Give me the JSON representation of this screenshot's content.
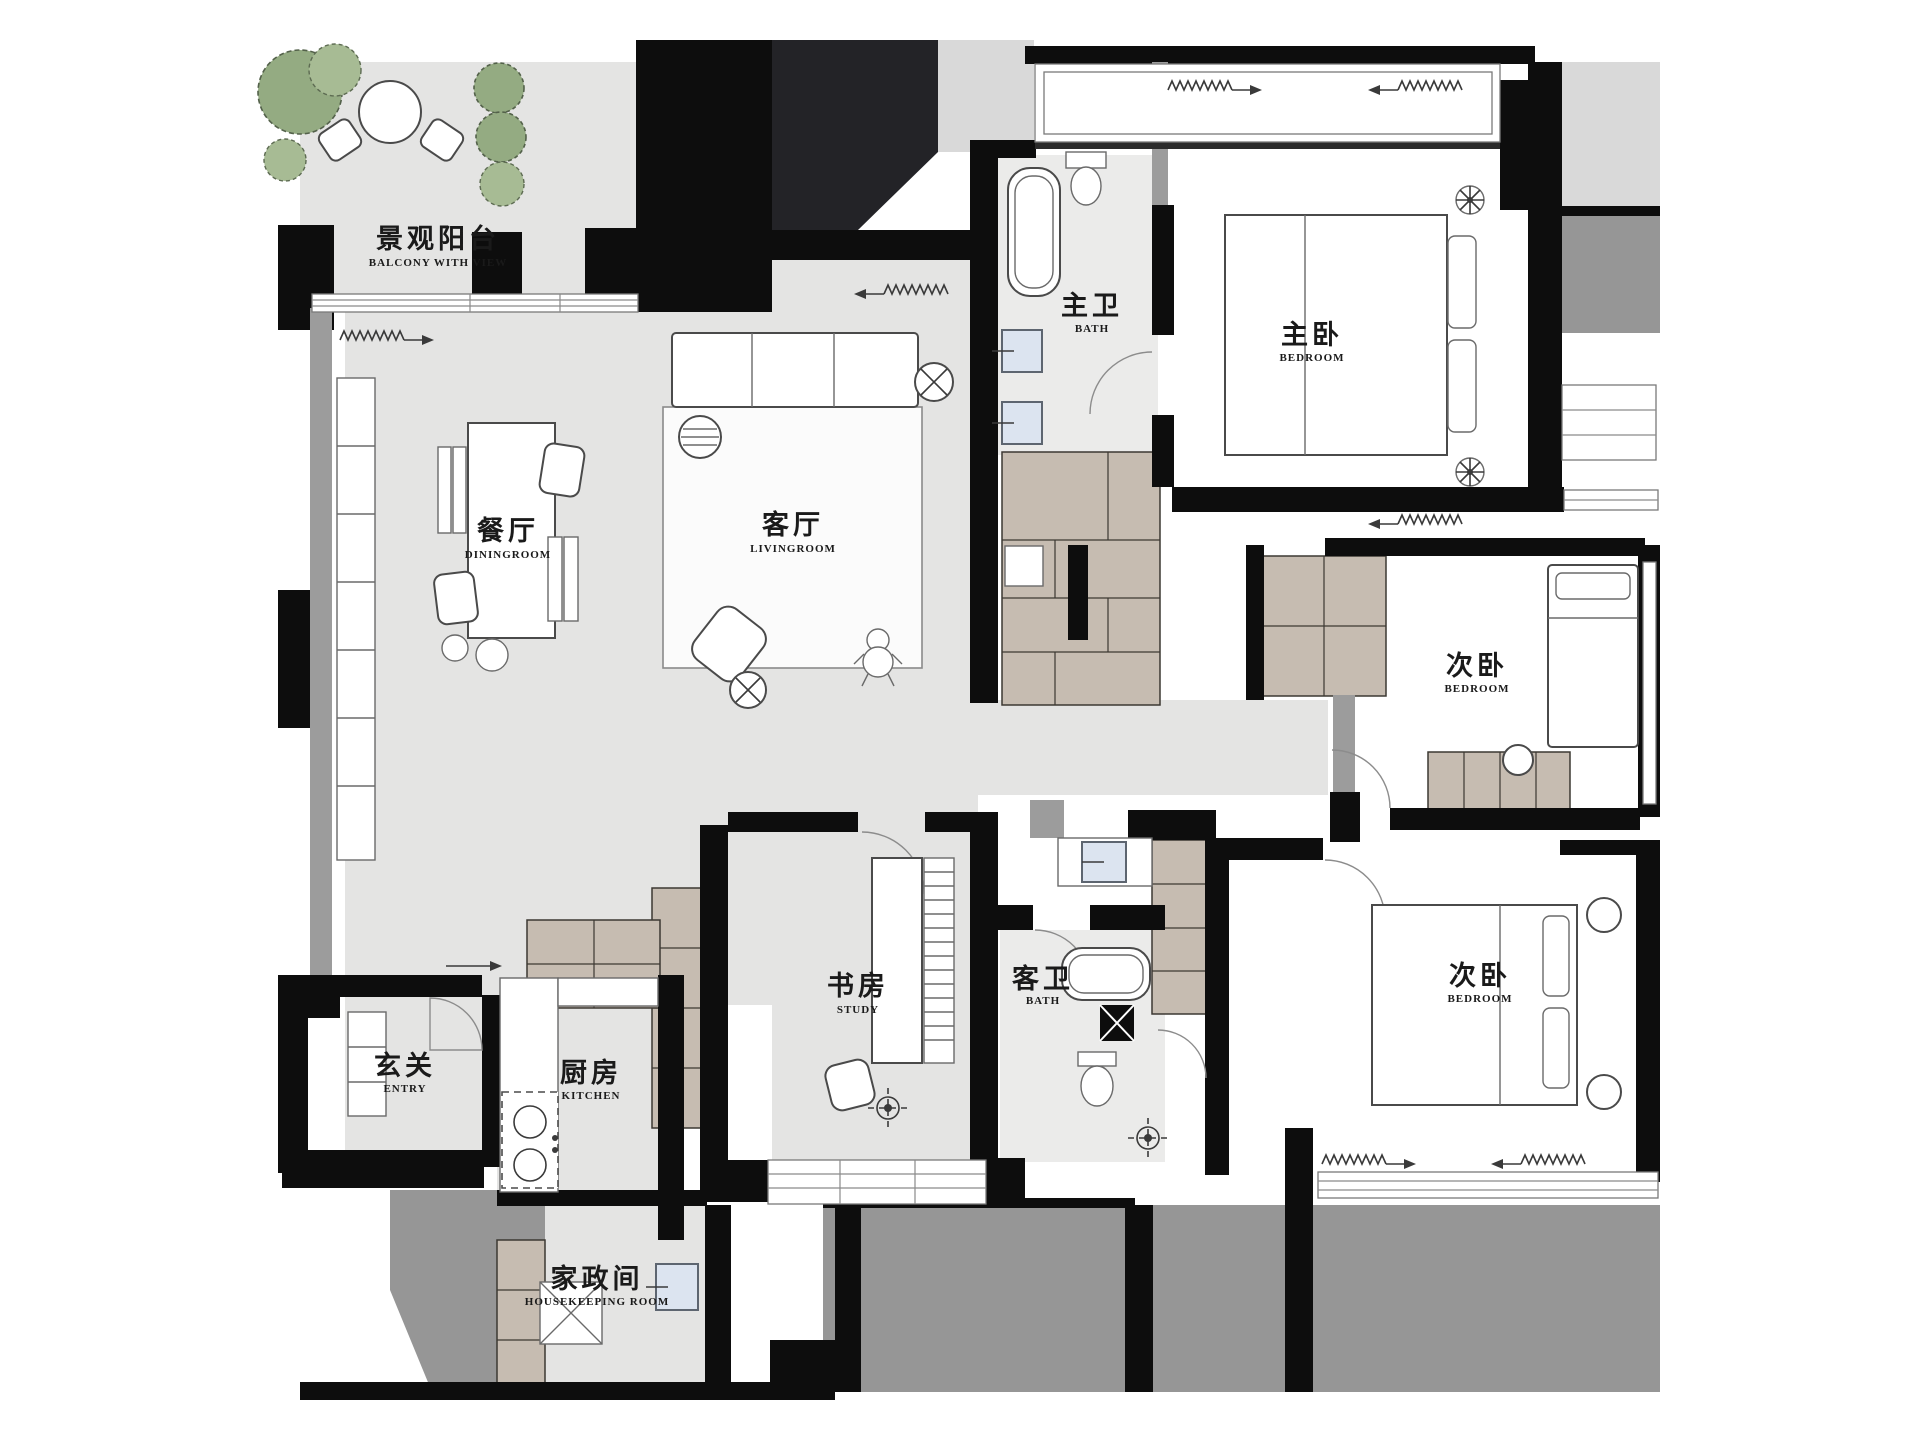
{
  "plan": {
    "type": "apartment-floor-plan",
    "rooms": [
      {
        "id": "balcony",
        "zh": "景观阳台",
        "en": "BALCONY WITH VIEW"
      },
      {
        "id": "dining",
        "zh": "餐厅",
        "en": "DININGROOM"
      },
      {
        "id": "living",
        "zh": "客厅",
        "en": "LIVINGROOM"
      },
      {
        "id": "master-bath",
        "zh": "主卫",
        "en": "BATH"
      },
      {
        "id": "master-bedroom",
        "zh": "主卧",
        "en": "BEDROOM"
      },
      {
        "id": "bedroom-2",
        "zh": "次卧",
        "en": "BEDROOM"
      },
      {
        "id": "bedroom-3",
        "zh": "次卧",
        "en": "BEDROOM"
      },
      {
        "id": "study",
        "zh": "书房",
        "en": "STUDY"
      },
      {
        "id": "guest-bath",
        "zh": "客卫",
        "en": "BATH"
      },
      {
        "id": "entry",
        "zh": "玄关",
        "en": "ENTRY"
      },
      {
        "id": "kitchen",
        "zh": "厨房",
        "en": "KITCHEN"
      },
      {
        "id": "housekeeping",
        "zh": "家政间",
        "en": "HOUSEKEEPING ROOM"
      }
    ],
    "palette": {
      "wall": "#0d0d0d",
      "floor": "#e4e4e3",
      "slab": "#969696",
      "cabinet": "#c6bcb1",
      "plant_green": "#94ab82",
      "fixture_blue": "#dce4f0",
      "paper": "#ffffff"
    }
  }
}
